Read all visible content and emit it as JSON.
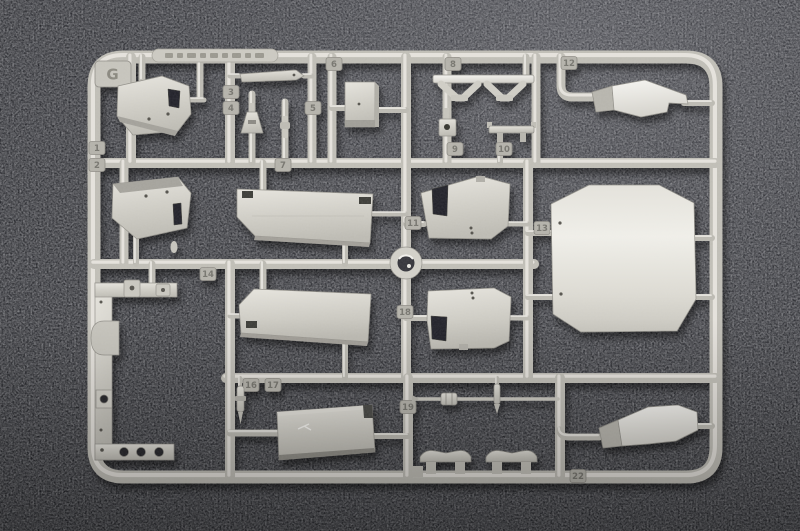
{
  "photo": {
    "alt": "Injection-molded model kit sprue, runner G, light grey styrene parts on dark speckled fabric",
    "sprue_letter": "G"
  },
  "tags": [
    "G",
    "1",
    "2",
    "3",
    "4",
    "5",
    "6",
    "7",
    "8",
    "9",
    "10",
    "11",
    "12",
    "13",
    "14",
    "16",
    "17",
    "18",
    "19",
    "22"
  ],
  "colors": {
    "background": "#2a2b30",
    "background_light": "#46474d",
    "background_dark": "#1f2024",
    "plastic": "#c0beb6",
    "plastic_highlight": "#ebe9e3",
    "plastic_bright": "#f4f3ef",
    "plastic_shadow": "#8f8d86",
    "tag_plate": "#b4b2aa",
    "tag_text": "#76746e",
    "cutout": "#232429"
  }
}
